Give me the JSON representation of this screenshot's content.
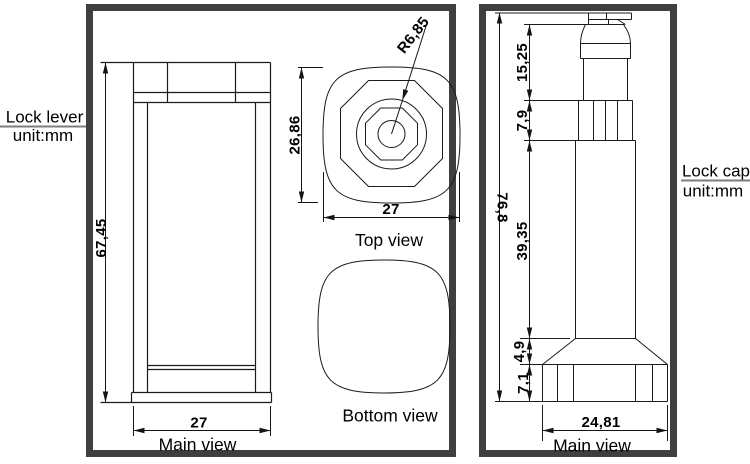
{
  "left_panel": {
    "title": "Lock lever",
    "unit": "unit:mm",
    "main_view": {
      "label": "Main view",
      "height": "67,45",
      "width": "27"
    },
    "top_view": {
      "label": "Top view",
      "height": "26,86",
      "width": "27",
      "radius": "R6,85"
    },
    "bottom_view": {
      "label": "Bottom view"
    }
  },
  "right_panel": {
    "title": "Lock cap",
    "unit": "unit:mm",
    "main_view": {
      "label": "Main view",
      "total_height": "76,8",
      "head_height": "15,25",
      "collar_height": "7,9",
      "shaft_height": "39,35",
      "taper_height": "4,9",
      "base_height": "7,1",
      "base_width": "24,81"
    }
  }
}
